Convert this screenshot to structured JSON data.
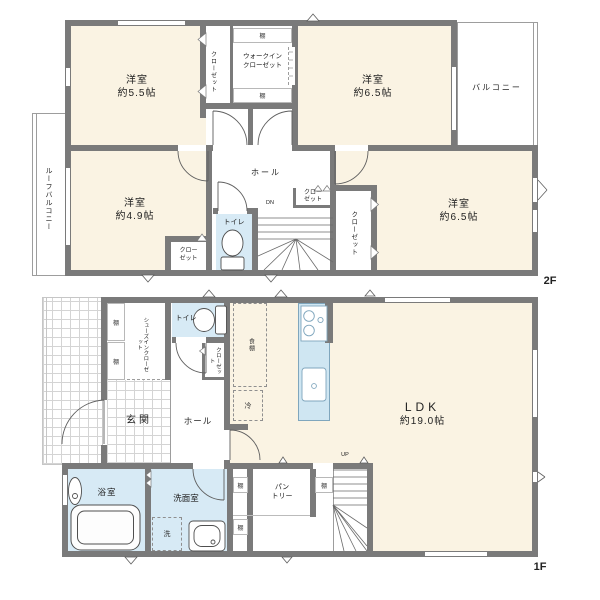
{
  "colors": {
    "wall": "#7a7a7a",
    "room_floor": "#faf3e3",
    "wet_area": "#d7eaf5",
    "kitchen_counter": "#cfe6f2",
    "kitchen_outline": "#7fa6bd",
    "tile_line": "#d4d4d4"
  },
  "floor2": {
    "floor_label": "2F",
    "rooms": {
      "bedroom_55": {
        "name": "洋室",
        "size": "約5.5帖"
      },
      "bedroom_65a": {
        "name": "洋室",
        "size": "約6.5帖"
      },
      "bedroom_49": {
        "name": "洋室",
        "size": "約4.9帖"
      },
      "bedroom_65b": {
        "name": "洋室",
        "size": "約6.5帖"
      }
    },
    "closet_left": "クローゼット",
    "wic_l1": "ウォークイン",
    "wic_l2": "クローゼット",
    "shelf": "棚",
    "balcony": "バルコニー",
    "roof_balcony": "ルーフバルコニー",
    "closet_49_l1": "クロー",
    "closet_49_l2": "ゼット",
    "hall": "ホール",
    "stairs_down": "DN",
    "closet_hall_l1": "クロー",
    "closet_hall_l2": "ゼット",
    "toilet": "トイレ",
    "closet_right": "クローゼット"
  },
  "floor1": {
    "floor_label": "1F",
    "shoes_closet": "シューズインクローゼット",
    "shelf": "棚",
    "toilet": "トイレ",
    "closet": "クローゼット",
    "entrance": "玄関",
    "hall": "ホール",
    "cupboard": "食棚",
    "refrigerator": "冷",
    "ldk": {
      "name": "LDK",
      "size": "約19.0帖"
    },
    "bath": "浴室",
    "washroom": "洗面室",
    "washer": "洗",
    "pantry_l1": "パン",
    "pantry_l2": "トリー",
    "stairs_up": "UP"
  }
}
